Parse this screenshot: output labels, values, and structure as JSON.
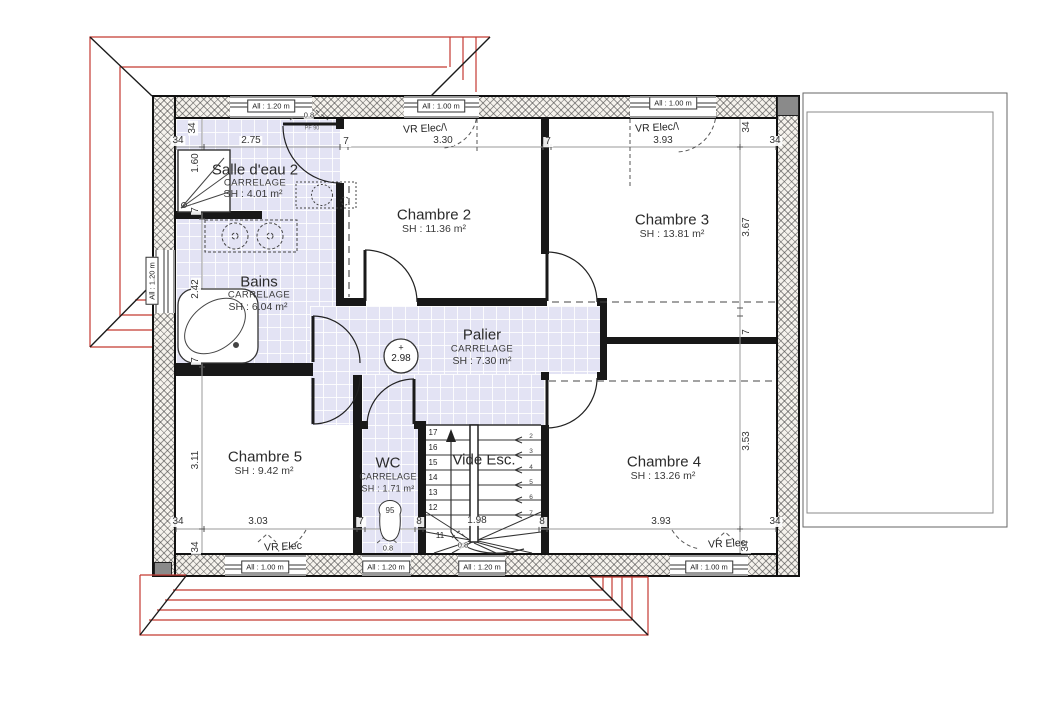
{
  "plan": {
    "rooms": [
      {
        "name": "Salle d'eau 2",
        "finish": "CARRELAGE",
        "area": "SH : 4.01 m²"
      },
      {
        "name": "Bains",
        "finish": "CARRELAGE",
        "area": "SH : 6.04 m²"
      },
      {
        "name": "Chambre 2",
        "area": "SH : 11.36 m²"
      },
      {
        "name": "Chambre 3",
        "area": "SH : 13.81 m²"
      },
      {
        "name": "Palier",
        "finish": "CARRELAGE",
        "area": "SH : 7.30 m²"
      },
      {
        "name": "Chambre 5",
        "area": "SH : 9.42 m²"
      },
      {
        "name": "WC",
        "finish": "CARRELAGE",
        "area": "SH : 1.71 m²"
      },
      {
        "name": "Vide Esc."
      },
      {
        "name": "Chambre 4",
        "area": "SH : 13.26 m²"
      }
    ],
    "level_mark": "2.98",
    "colors": {
      "roof_line": "#c43a32",
      "tile": "#e3e3f4",
      "wall": "#181818"
    },
    "stairs": {
      "left_steps": [
        "17",
        "16",
        "15",
        "14",
        "13",
        "12"
      ],
      "right_steps": [
        "2",
        "3",
        "4",
        "5",
        "6",
        "7"
      ],
      "winder_step": "11",
      "width_dim": "1.98"
    },
    "windows": [
      {
        "t": "All : 1.20 m",
        "x": 271,
        "y": 106,
        "r": 0
      },
      {
        "t": "All : 1.00 m",
        "x": 441,
        "y": 106,
        "r": 0
      },
      {
        "t": "All : 1.00 m",
        "x": 673,
        "y": 103,
        "r": 0
      },
      {
        "t": "All : 1.00 m",
        "x": 265,
        "y": 567,
        "r": 0
      },
      {
        "t": "All : 1.20 m",
        "x": 386,
        "y": 567,
        "r": 0
      },
      {
        "t": "All : 1.20 m",
        "x": 482,
        "y": 567,
        "r": 0
      },
      {
        "t": "All : 1.00 m",
        "x": 709,
        "y": 567,
        "r": 0
      },
      {
        "t": "All : 1.20 m",
        "x": 152,
        "y": 281,
        "r": -90
      }
    ],
    "labels": [
      {
        "n": "room-label-salle-deau-2",
        "t": "Salle d'eau 2",
        "x": 255,
        "y": 170,
        "c": "room"
      },
      {
        "n": "finish-salle-deau-2",
        "t": "CARRELAGE",
        "x": 255,
        "y": 183,
        "c": "subc"
      },
      {
        "n": "area-salle-deau-2",
        "t": "SH : 4.01 m²",
        "x": 253,
        "y": 194,
        "c": "sub"
      },
      {
        "n": "room-label-bains",
        "t": "Bains",
        "x": 259,
        "y": 282,
        "c": "room"
      },
      {
        "n": "finish-bains",
        "t": "CARRELAGE",
        "x": 259,
        "y": 295,
        "c": "subc"
      },
      {
        "n": "area-bains",
        "t": "SH : 6.04 m²",
        "x": 258,
        "y": 307,
        "c": "sub"
      },
      {
        "n": "room-label-chambre-2",
        "t": "Chambre 2",
        "x": 434,
        "y": 215,
        "c": "room"
      },
      {
        "n": "area-chambre-2",
        "t": "SH : 11.36 m²",
        "x": 434,
        "y": 229,
        "c": "sub"
      },
      {
        "n": "room-label-chambre-3",
        "t": "Chambre 3",
        "x": 672,
        "y": 220,
        "c": "room"
      },
      {
        "n": "area-chambre-3",
        "t": "SH : 13.81 m²",
        "x": 672,
        "y": 234,
        "c": "sub"
      },
      {
        "n": "room-label-palier",
        "t": "Palier",
        "x": 482,
        "y": 335,
        "c": "room"
      },
      {
        "n": "finish-palier",
        "t": "CARRELAGE",
        "x": 482,
        "y": 349,
        "c": "subc"
      },
      {
        "n": "area-palier",
        "t": "SH : 7.30 m²",
        "x": 482,
        "y": 361,
        "c": "sub"
      },
      {
        "n": "room-label-chambre-5",
        "t": "Chambre 5",
        "x": 265,
        "y": 457,
        "c": "room"
      },
      {
        "n": "area-chambre-5",
        "t": "SH : 9.42 m²",
        "x": 264,
        "y": 471,
        "c": "sub"
      },
      {
        "n": "room-label-wc",
        "t": "WC",
        "x": 388,
        "y": 463,
        "c": "room"
      },
      {
        "n": "finish-wc",
        "t": "CARRELAGE",
        "x": 388,
        "y": 477,
        "c": "sub2"
      },
      {
        "n": "area-wc",
        "t": "SH : 1.71 m²",
        "x": 388,
        "y": 489,
        "c": "sub2"
      },
      {
        "n": "room-label-chambre-4",
        "t": "Chambre 4",
        "x": 664,
        "y": 462,
        "c": "room"
      },
      {
        "n": "area-chambre-4",
        "t": "SH : 13.26 m²",
        "x": 663,
        "y": 476,
        "c": "sub"
      },
      {
        "n": "room-label-vide-esc",
        "t": "Vide Esc.",
        "x": 484,
        "y": 460,
        "c": "room"
      },
      {
        "n": "dim-top-34a",
        "t": "34",
        "x": 178,
        "y": 141,
        "c": "dim"
      },
      {
        "n": "dim-top-275",
        "t": "2.75",
        "x": 251,
        "y": 141,
        "c": "dim"
      },
      {
        "n": "dim-top-7a",
        "t": "7",
        "x": 346,
        "y": 142,
        "c": "dim"
      },
      {
        "n": "dim-top-330",
        "t": "3.30",
        "x": 443,
        "y": 141,
        "c": "dim"
      },
      {
        "n": "dim-top-7b",
        "t": "7",
        "x": 548,
        "y": 142,
        "c": "dim"
      },
      {
        "n": "dim-top-393",
        "t": "3.93",
        "x": 663,
        "y": 141,
        "c": "dim"
      },
      {
        "n": "dim-top-34b",
        "t": "34",
        "x": 775,
        "y": 141,
        "c": "dim"
      },
      {
        "n": "dim-top-34-rot-l",
        "t": "34",
        "x": 193,
        "y": 128,
        "c": "dim",
        "r": -90
      },
      {
        "n": "dim-top-34-rot-r",
        "t": "34",
        "x": 747,
        "y": 127,
        "c": "dim",
        "r": -90
      },
      {
        "n": "dim-bot-34a",
        "t": "34",
        "x": 178,
        "y": 522,
        "c": "dim"
      },
      {
        "n": "dim-bot-303",
        "t": "3.03",
        "x": 258,
        "y": 522,
        "c": "dim"
      },
      {
        "n": "dim-bot-7",
        "t": "7",
        "x": 361,
        "y": 522,
        "c": "dim"
      },
      {
        "n": "dim-bot-8a",
        "t": "8",
        "x": 419,
        "y": 522,
        "c": "dim"
      },
      {
        "n": "dim-bot-198",
        "t": "1.98",
        "x": 477,
        "y": 521,
        "c": "dim"
      },
      {
        "n": "dim-bot-8b",
        "t": "8",
        "x": 542,
        "y": 522,
        "c": "dim"
      },
      {
        "n": "dim-bot-393",
        "t": "3.93",
        "x": 661,
        "y": 522,
        "c": "dim"
      },
      {
        "n": "dim-bot-34b",
        "t": "34",
        "x": 775,
        "y": 522,
        "c": "dim"
      },
      {
        "n": "dim-bot-34-rot-l",
        "t": "34",
        "x": 196,
        "y": 547,
        "c": "dim",
        "r": -90
      },
      {
        "n": "dim-bot-34-rot-r",
        "t": "34",
        "x": 746,
        "y": 546,
        "c": "dim",
        "r": -90
      },
      {
        "n": "dim-left-160",
        "t": "1.60",
        "x": 196,
        "y": 163,
        "c": "dim",
        "r": -90
      },
      {
        "n": "dim-left-7a",
        "t": "7",
        "x": 196,
        "y": 210,
        "c": "dim",
        "r": -90
      },
      {
        "n": "dim-left-242",
        "t": "2.42",
        "x": 196,
        "y": 289,
        "c": "dim",
        "r": -90
      },
      {
        "n": "dim-left-7b",
        "t": "7",
        "x": 196,
        "y": 360,
        "c": "dim",
        "r": -90
      },
      {
        "n": "dim-left-311",
        "t": "3.11",
        "x": 196,
        "y": 460,
        "c": "dim",
        "r": -90
      },
      {
        "n": "dim-right-367",
        "t": "3.67",
        "x": 747,
        "y": 227,
        "c": "dim",
        "r": -90
      },
      {
        "n": "dim-right-7",
        "t": "7",
        "x": 747,
        "y": 332,
        "c": "dim",
        "r": -90
      },
      {
        "n": "dim-right-353",
        "t": "3.53",
        "x": 747,
        "y": 441,
        "c": "dim",
        "r": -90
      },
      {
        "n": "vr-label-top-1",
        "t": "VR Elec/\\",
        "x": 425,
        "y": 129,
        "c": "vr",
        "r": -3
      },
      {
        "n": "vr-label-top-2",
        "t": "VR Elec/\\",
        "x": 657,
        "y": 128,
        "c": "vr",
        "r": -3
      },
      {
        "n": "vr-label-bot-1",
        "t": "VR Elec",
        "x": 283,
        "y": 547,
        "c": "vr",
        "r": -3
      },
      {
        "n": "vr-label-bot-2",
        "t": "VR Elec",
        "x": 727,
        "y": 544,
        "c": "vr",
        "r": -3
      },
      {
        "n": "ann-08-top",
        "t": "0.8",
        "x": 309,
        "y": 115,
        "c": "tiny"
      },
      {
        "n": "ann-08-left",
        "t": "0.8",
        "x": 149,
        "y": 268,
        "c": "tiny",
        "r": -90
      },
      {
        "n": "ann-08-wc",
        "t": "0.8",
        "x": 388,
        "y": 548,
        "c": "tiny"
      },
      {
        "n": "ann-08-stair",
        "t": "0.8",
        "x": 463,
        "y": 545,
        "c": "tiny"
      },
      {
        "n": "ann-toilet-95",
        "t": "95",
        "x": 390,
        "y": 511,
        "c": "tiny2"
      },
      {
        "n": "ann-pf90",
        "t": "PF 90",
        "x": 312,
        "y": 129,
        "c": "pf"
      },
      {
        "n": "level-plus",
        "t": "+",
        "x": 401,
        "y": 348,
        "c": "lvlp"
      },
      {
        "n": "level-value",
        "t": "2.98",
        "x": 401,
        "y": 359,
        "c": "lvl"
      },
      {
        "n": "stair-step-11",
        "t": "11",
        "x": 440,
        "y": 536,
        "c": "step"
      }
    ]
  }
}
